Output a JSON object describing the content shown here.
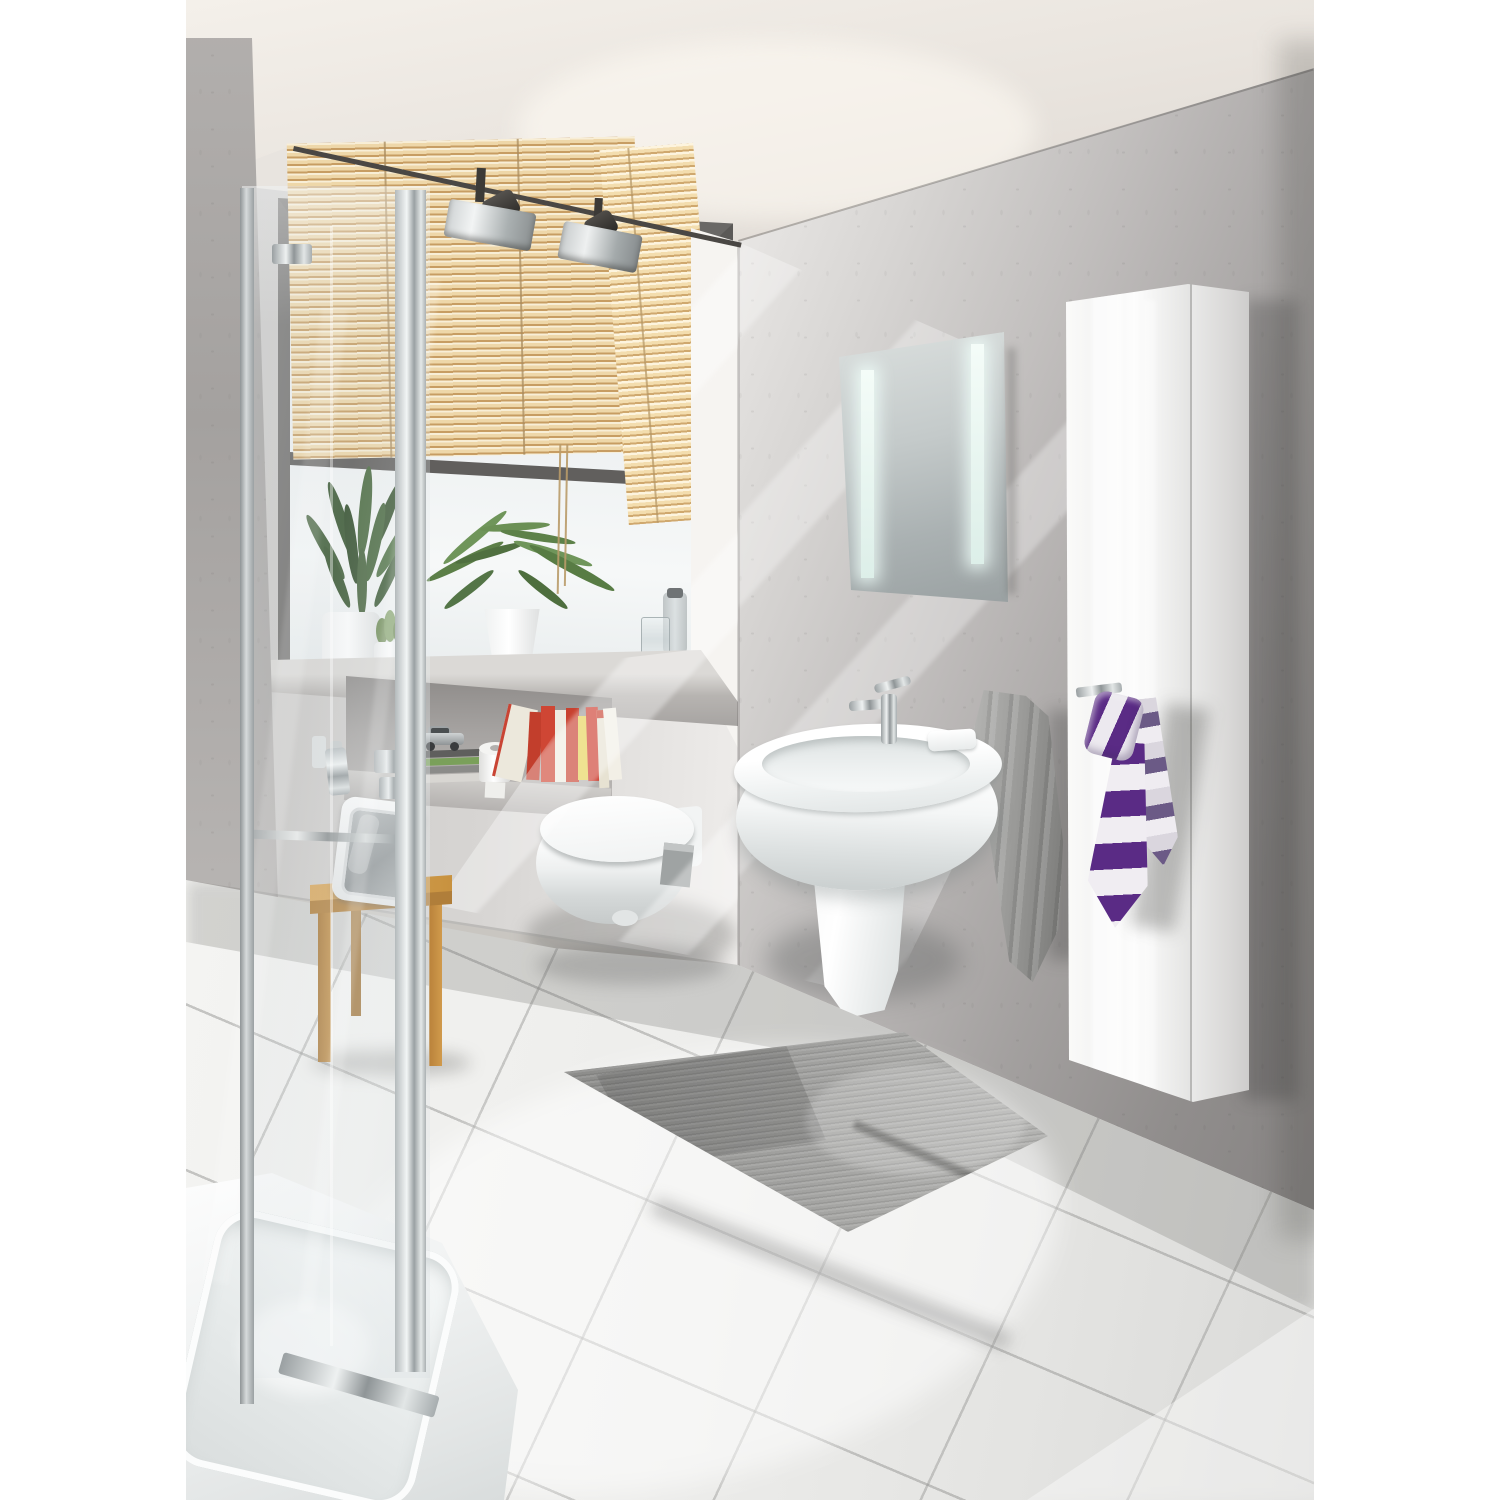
{
  "image": {
    "type": "photograph",
    "subject": "modern bathroom interior with concrete walls",
    "format": "portrait photo centered on white page"
  },
  "palette": {
    "page_background": "#ffffff",
    "ceiling": "#e9e3dd",
    "concrete_light": "#d6d4d2",
    "concrete_dark": "#8f8c8b",
    "window_glow": "#f6efe2",
    "blinds_wood": "#ecd2a0",
    "blinds_shadow": "#c49a5e",
    "fixture_white": "#fafbfb",
    "chrome": "#c7cbcd",
    "towel_gray": "#9b9b99",
    "tie_purple": "#5a2b85",
    "stool_wood": "#cd9a4e",
    "mat_gray": "#9a9a98",
    "floor_tile": "#f0f0ee",
    "plant_green": "#47663c",
    "book_red": "#c63f2e",
    "book_yellow": "#e5cf3e"
  },
  "objects": {
    "photo": "modern bathroom interior photograph",
    "ceiling": "ceiling",
    "track_rail": "ceiling light track rail",
    "spotlight1": "track spotlight fixture",
    "spotlight2": "track spotlight fixture",
    "pillar": "concrete pillar of shower wall",
    "window_wall": "back wall with window",
    "window": "frosted window with gray frame",
    "blinds_left": "wooden venetian blind, raised",
    "blinds_right": "wooden venetian blind, lowered",
    "sill": "concrete window sill",
    "niche": "concrete wall niche shelf",
    "books": "row of books in niche",
    "toy_car": "silver toy car on magazine stack",
    "magazines": "stack of magazines",
    "toilet_roll": "toilet paper roll",
    "zz_plant": "green leafy plant in white pot",
    "cactus": "small cactus in white pot",
    "aloe_plant": "aloe plant in white pot",
    "water_glass": "drinking glass on sill",
    "bottle": "gray bottle on sill",
    "toilet": "white wall-hung toilet",
    "right_wall": "concrete side wall",
    "light_streaks": "diagonal sunlight streaks",
    "mirror": "illuminated mirror with two LED strips",
    "cabinet": "tall white gloss cabinet",
    "hook": "chrome towel hook",
    "striped_tie": "purple and white striped towel tied like a necktie",
    "gray_towel": "gray towel hanging on wall",
    "sink": "white wall-hung washbasin with half pedestal",
    "faucet": "chrome single-lever faucet",
    "soap_dish": "white soap dish on basin rim",
    "floor": "white tiled floor",
    "bath_mat": "gray bath mat",
    "shower_tray": "white shower tray",
    "shower_glass": "glass shower enclosure",
    "stool": "wooden stool",
    "radio": "retro radio on stool"
  }
}
